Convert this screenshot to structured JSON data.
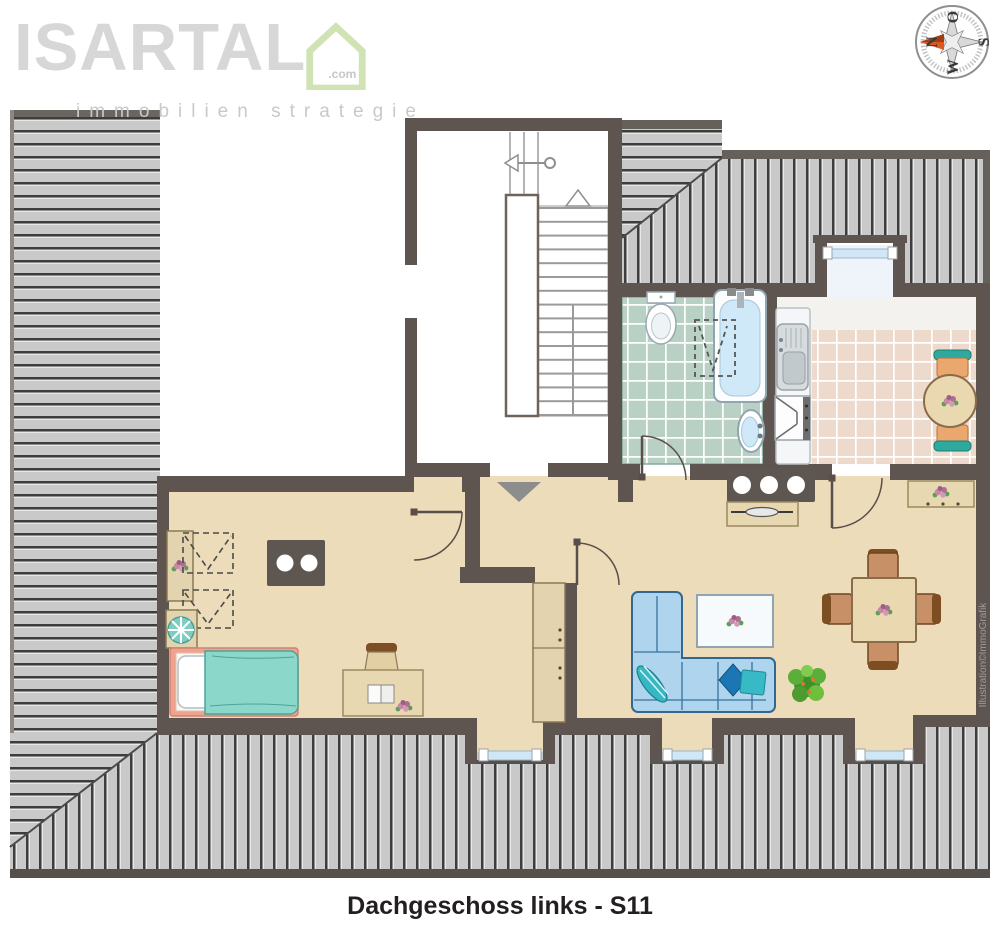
{
  "branding": {
    "name": "ISARTAL",
    "tld": ".com",
    "tagline": "immobilien strategie"
  },
  "compass": {
    "n": "N",
    "e": "O",
    "s": "S",
    "w": "W"
  },
  "caption": "Dachgeschoss links - S11",
  "credit": "Illustration©ImmoGrafik",
  "colors": {
    "wall": "#5e5550",
    "floor_beige": "#ecdcba",
    "bath_tile": "#b9d0c4",
    "kitchen_tile": "#eed9cd",
    "roof_hatch_light": "#c9c9c9",
    "roof_hatch_dark": "#3d3d3d",
    "sofa_blue": "#aed4ee",
    "bed_teal": "#8bd8ca",
    "accent_teal": "#2fa99e",
    "chair_brown": "#c89067",
    "table_tan": "#ead8b0",
    "north_arrow": "#e0561f",
    "logo_gray": "#d7d7d7",
    "logo_green": "#cfe3b4"
  }
}
